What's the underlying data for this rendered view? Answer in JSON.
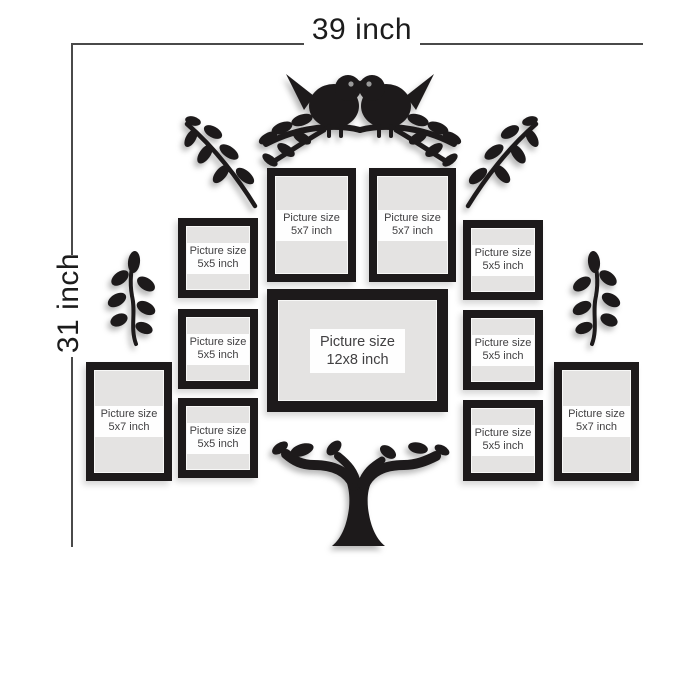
{
  "dimension_annotations": {
    "width_label": "39 inch",
    "height_label": "31 inch"
  },
  "frames": [
    {
      "name": "top-center-left-5x7",
      "line1": "Picture size",
      "line2": "5x7 inch"
    },
    {
      "name": "top-center-right-5x7",
      "line1": "Picture size",
      "line2": "5x7 inch"
    },
    {
      "name": "center-12x8",
      "line1": "Picture size",
      "line2": "12x8 inch"
    },
    {
      "name": "left-column-top-5x5",
      "line1": "Picture size",
      "line2": "5x5 inch"
    },
    {
      "name": "left-column-middle-5x5",
      "line1": "Picture size",
      "line2": "5x5 inch"
    },
    {
      "name": "left-column-bottom-5x5",
      "line1": "Picture size",
      "line2": "5x5 inch"
    },
    {
      "name": "right-column-top-5x5",
      "line1": "Picture size",
      "line2": "5x5 inch"
    },
    {
      "name": "right-column-middle-5x5",
      "line1": "Picture size",
      "line2": "5x5 inch"
    },
    {
      "name": "right-column-bottom-5x5",
      "line1": "Picture size",
      "line2": "5x5 inch"
    },
    {
      "name": "bottom-left-5x7",
      "line1": "Picture size",
      "line2": "5x7 inch"
    },
    {
      "name": "bottom-right-5x7",
      "line1": "Picture size",
      "line2": "5x7 inch"
    }
  ],
  "decorations": [
    "love-birds-on-branch-silhouette",
    "corner-branch-silhouette-left",
    "corner-branch-silhouette-right",
    "leaf-sprig-silhouette-left",
    "leaf-sprig-silhouette-right",
    "tree-trunk-silhouette"
  ],
  "colors": {
    "background": "#ffffff",
    "silhouette_black": "#1d1a1b",
    "frame_border": "#1d1a1b",
    "frame_mat": "#e4e3e2",
    "label_background": "#fefefe",
    "label_text": "#414042",
    "dimension_line": "#4a4a4a",
    "dimension_text": "#1c1c1c",
    "bird_eye": "#999999"
  }
}
